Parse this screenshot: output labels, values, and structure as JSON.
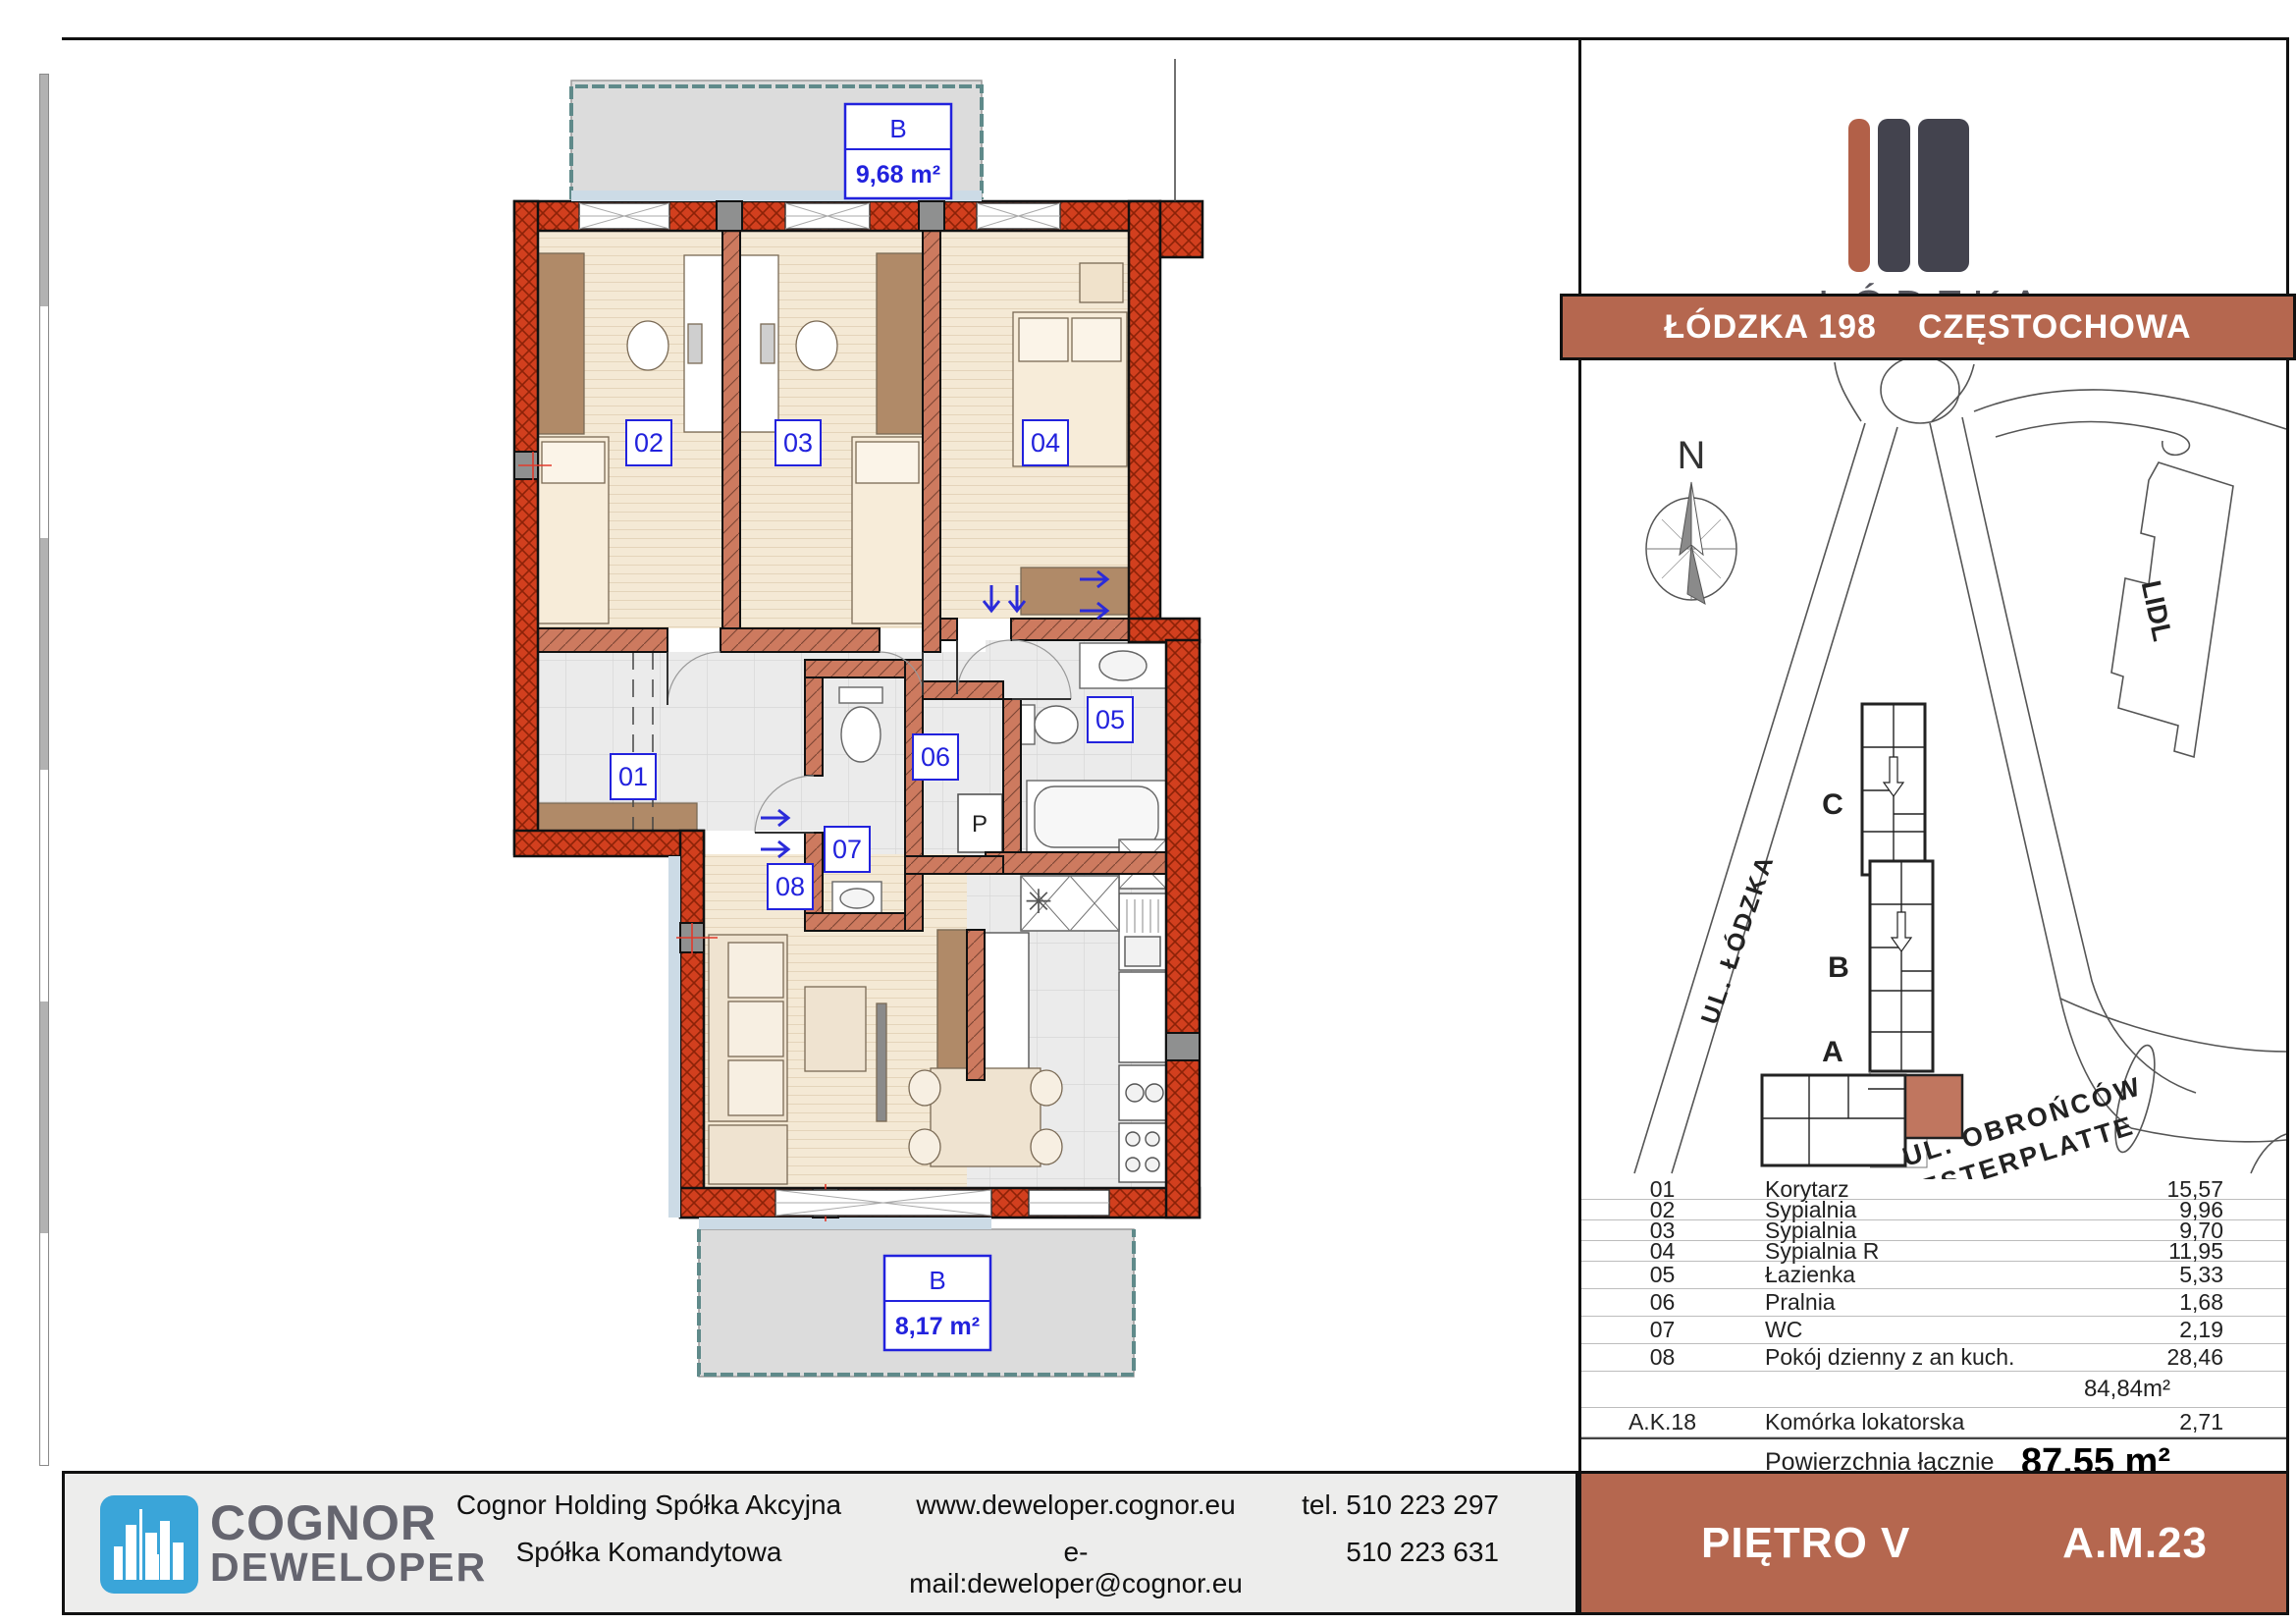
{
  "header": {
    "logo_title": "ŁÓDZKA",
    "logo_subtitle": "OSIEDLE",
    "banner_left": "ŁÓDZKA 198",
    "banner_right": "CZĘSTOCHOWA",
    "floor_label": "PIĘTRO V",
    "unit_label": "A.M.23"
  },
  "plan": {
    "room_ids": [
      "01",
      "02",
      "03",
      "04",
      "05",
      "06",
      "07",
      "08"
    ],
    "balconies": [
      {
        "label": "B",
        "area": "9,68 m²"
      },
      {
        "label": "B",
        "area": "8,17 m²"
      }
    ],
    "washer_label": "P"
  },
  "map": {
    "north": "N",
    "building_a": "A",
    "building_b": "B",
    "building_c": "C",
    "lidl": "LIDL",
    "street_lodzka": "UL. ŁÓDZKA",
    "street_obroncow_1": "UL. OBROŃCÓW",
    "street_obroncow_2": "WESTERPLATTE"
  },
  "table": {
    "rows": [
      {
        "no": "01",
        "name": "Korytarz",
        "area": "15,57"
      },
      {
        "no": "02",
        "name": "Sypialnia",
        "area": "9,96"
      },
      {
        "no": "03",
        "name": "Sypialnia",
        "area": "9,70"
      },
      {
        "no": "04",
        "name": "Sypialnia R",
        "area": "11,95"
      },
      {
        "no": "05",
        "name": "Łazienka",
        "area": "5,33"
      },
      {
        "no": "06",
        "name": "Pralnia",
        "area": "1,68"
      },
      {
        "no": "07",
        "name": "WC",
        "area": "2,19"
      },
      {
        "no": "08",
        "name": "Pokój dzienny z an kuch.",
        "area": "28,46"
      }
    ],
    "subtotal": "84,84m²",
    "storage": {
      "no": "A.K.18",
      "name": "Komórka lokatorska",
      "area": "2,71"
    },
    "total_label": "Powierzchnia łącznie",
    "total_value": "87,55 m²"
  },
  "footer": {
    "brand_line1": "COGNOR",
    "brand_line2": "DEWELOPER",
    "company_line1": "Cognor Holding Spółka Akcyjna",
    "company_line2": "Spółka Komandytowa",
    "web": "www.deweloper.cognor.eu",
    "email": "e-mail:deweloper@cognor.eu",
    "phone1": "tel. 510 223 297",
    "phone2": "510 223 631"
  },
  "colors": {
    "accent_red": "#b5674f",
    "wall_exterior": "#d23f1e",
    "wall_interior": "#cd7a5f",
    "label_blue": "#2222dd",
    "cognor_blue": "#3aa5d9"
  }
}
